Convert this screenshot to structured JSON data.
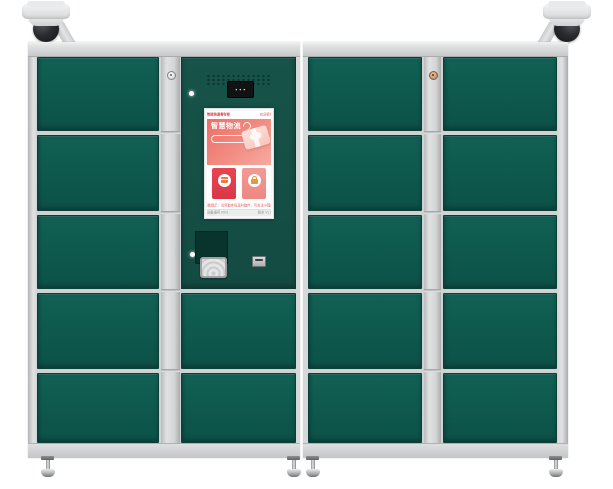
{
  "colors": {
    "door_green": "#0E584D",
    "console_green": "#144F46",
    "frame_gray": "#D4D6D7",
    "lock_strip_gray": "#D3D5D6",
    "screen_accent_red": "#D93846",
    "screen_button_pink": "#EE8782",
    "screen_banner_gradient": [
      "#EE6D66",
      "#F6AB9F"
    ],
    "camera_dome": "#1F2125",
    "background": "#FFFFFF"
  },
  "hardware": {
    "cameras": {
      "count": 2,
      "placement": "top-left and top-right corners"
    },
    "cabinets": {
      "left": {
        "door_columns": 1,
        "rows": 5,
        "doors": 5,
        "has_console": true,
        "console_lower_doors": 2
      },
      "right": {
        "door_columns": 2,
        "rows": 5,
        "doors": 10
      }
    },
    "feet_count": 4,
    "locks": {
      "left_strip": "round keyhole",
      "right_strip": "round keyhole"
    }
  },
  "icons": {
    "camera_left": "dome-surveillance-camera",
    "camera_right": "dome-surveillance-camera",
    "scanner_leds": "● ● ●",
    "swirl": "decorative-swirl",
    "deposit_icon": "parcel-box",
    "pickup_icon": "lock",
    "nfc_pad": "contactless-reader-arcs",
    "card_slot": "card-slot"
  },
  "screen": {
    "header": {
      "left": "智能快递寄存柜",
      "right": "欢迎使用"
    },
    "banner": {
      "title": "智慧物流",
      "badge": "自助寄存 · 安全便捷",
      "features": [
        "快速存件 · 安全保管 · 扫码取件",
        "智能通知 · 自助操作 · 全天服务",
        "一键寄件 · 实时查询 · 方便快捷"
      ]
    },
    "actions": [
      {
        "label": "寄件"
      },
      {
        "label": "取件"
      }
    ],
    "notice": "温馨提示：请凭取件码及时取件，可关注小程序",
    "footer": {
      "left": "设备编号 0001",
      "right": "版本 V1.0"
    }
  }
}
